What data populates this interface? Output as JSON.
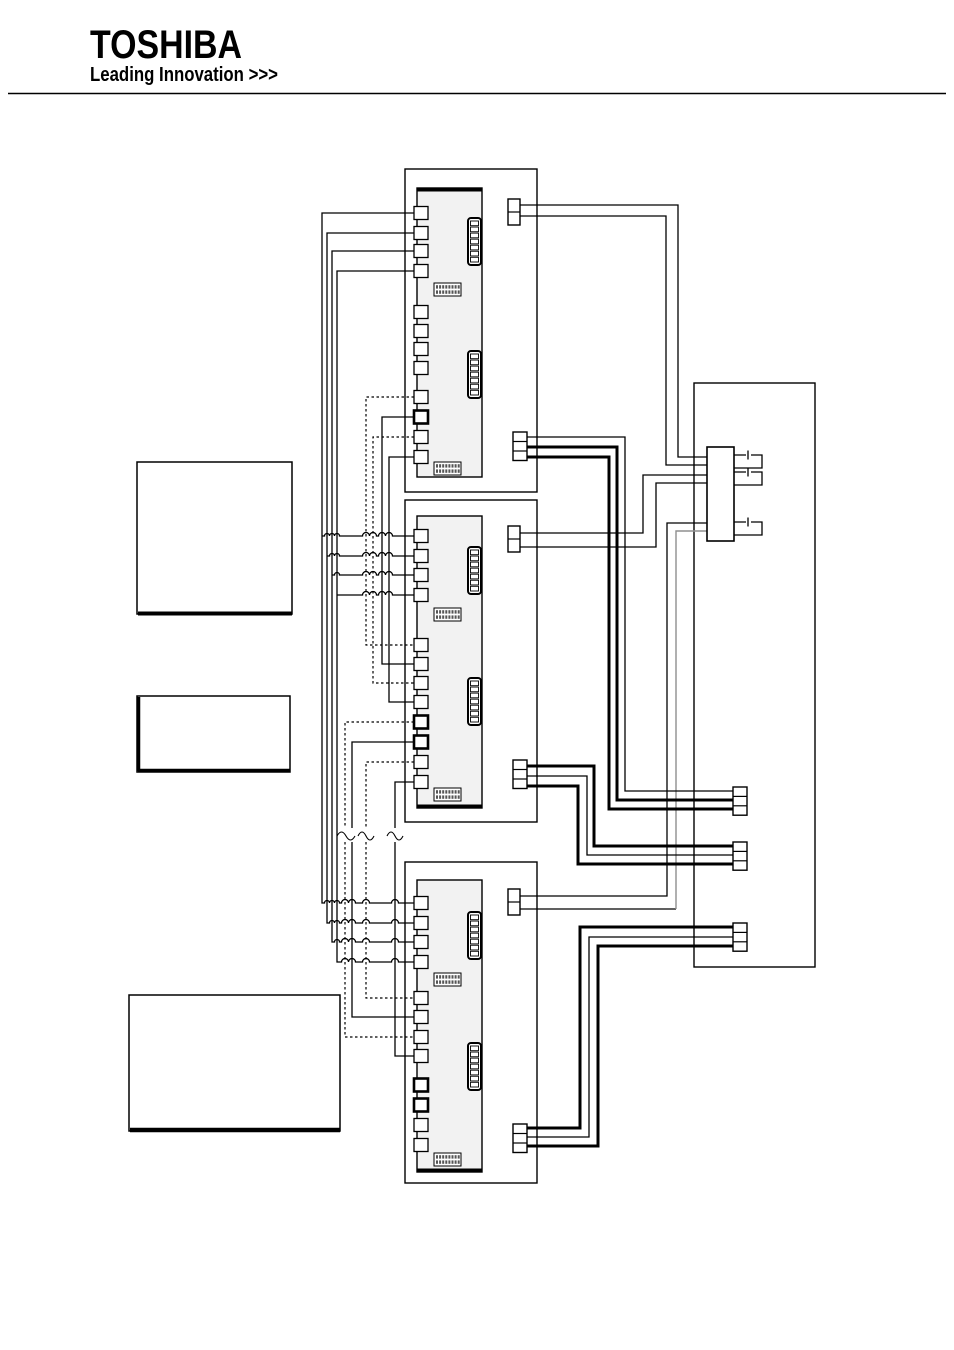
{
  "page": {
    "width": 954,
    "height": 1350,
    "bg": "#ffffff",
    "line_color": "#000000",
    "gray_wire": "#8f8f8f",
    "pcb_fill": "#f2f2f2",
    "fill_white": "#ffffff"
  },
  "logo": {
    "brand": "TOSHIBA",
    "tagline": "Leading Innovation >>>"
  },
  "diagram": {
    "description": "Wiring diagram: three indoor unit PCBs with left-side solid/dashed bus wiring (crossover hops, wavy break marks), top 2-pin and bottom 3-pin connectors, routed to right-hand box with terminal block, jumper links and three 3-pin connectors; three empty label boxes on the left",
    "shapes": [
      {
        "type": "line",
        "name": "header-rule",
        "x1": 8,
        "y1": 93.5,
        "x2": 946,
        "y2": 93.5,
        "sw": 1.5
      },
      {
        "type": "text",
        "name": "toshiba-logo-text",
        "x": 90,
        "y": 58,
        "size": 40,
        "weight": 800,
        "content_key": "brand",
        "textLength": 152
      },
      {
        "type": "text",
        "name": "toshiba-tagline-text",
        "x": 90,
        "y": 81,
        "size": 20,
        "weight": 700,
        "content_key": "tagline",
        "textLength": 188
      },
      {
        "type": "rect",
        "name": "label-box-1",
        "x": 137,
        "y": 462,
        "w": 155,
        "h": 152,
        "sw": 1.5,
        "fill": "#ffffff"
      },
      {
        "type": "path",
        "name": "label-box-1-shadow",
        "d": "M138,613.5 H292",
        "sw": 4
      },
      {
        "type": "rect",
        "name": "label-box-2",
        "x": 137,
        "y": 696,
        "w": 153,
        "h": 76,
        "sw": 1.5,
        "fill": "#ffffff"
      },
      {
        "type": "path",
        "name": "label-box-2-shadow",
        "d": "M138.5,697 V771 M138,770.5 H290",
        "sw": 3.5
      },
      {
        "type": "rect",
        "name": "label-box-3",
        "x": 129,
        "y": 995,
        "w": 211,
        "h": 136,
        "sw": 1.5,
        "fill": "#ffffff"
      },
      {
        "type": "path",
        "name": "label-box-3-shadow",
        "d": "M130,1130 H340",
        "sw": 4.5
      },
      {
        "type": "rect",
        "name": "unit-1-casing",
        "x": 405,
        "y": 169,
        "w": 132,
        "h": 323,
        "sw": 1.4,
        "fill": "none"
      },
      {
        "type": "rect",
        "name": "unit-2-casing",
        "x": 405,
        "y": 500,
        "w": 132,
        "h": 322,
        "sw": 1.4,
        "fill": "none"
      },
      {
        "type": "rect",
        "name": "unit-3-casing",
        "x": 405,
        "y": 862,
        "w": 132,
        "h": 321,
        "sw": 1.4,
        "fill": "none"
      },
      {
        "type": "rect",
        "name": "right-control-box",
        "x": 694,
        "y": 383,
        "w": 121,
        "h": 584,
        "sw": 1.4,
        "fill": "none"
      },
      {
        "type": "path",
        "name": "bus-a-wire-1",
        "d": "M414,213 H322 V903 H324.5 a2.5,2.5 0 0 1 5,0 a2.5,2.5 0 0 1 5,0 a2.5,2.5 0 0 1 5,0 H341.5 a3.5,3.5 0 0 1 7,0 a3.5,3.5 0 0 1 7,0 H362.5 a3.5,3.5 0 0 1 7,0 H391.5 a3.5,3.5 0 0 1 7,0 H414",
        "sw": 1.3
      },
      {
        "type": "path",
        "name": "bus-a-wire-2",
        "d": "M414,233 H327 V923 H329.5 a2.5,2.5 0 0 1 5,0 a2.5,2.5 0 0 1 5,0 H341.5 a3.5,3.5 0 0 1 7,0 a3.5,3.5 0 0 1 7,0 H362.5 a3.5,3.5 0 0 1 7,0 H391.5 a3.5,3.5 0 0 1 7,0 H414",
        "sw": 1.3
      },
      {
        "type": "path",
        "name": "bus-a-wire-3",
        "d": "M414,251 H332 V942 H334.5 a2.5,2.5 0 0 1 5,0 H341.5 a3.5,3.5 0 0 1 7,0 a3.5,3.5 0 0 1 7,0 H362.5 a3.5,3.5 0 0 1 7,0 H391.5 a3.5,3.5 0 0 1 7,0 H414",
        "sw": 1.3
      },
      {
        "type": "path",
        "name": "bus-a-wire-4",
        "d": "M414,271 H337 V962 H341.5 a3.5,3.5 0 0 1 7,0 a3.5,3.5 0 0 1 7,0 H362.5 a3.5,3.5 0 0 1 7,0 H391.5 a3.5,3.5 0 0 1 7,0 H414",
        "sw": 1.3
      },
      {
        "type": "path",
        "name": "bus-a-branch-unit2-1",
        "d": "M322,536 H324.5 a2.5,2.5 0 0 1 5,0 a2.5,2.5 0 0 1 5,0 a2.5,2.5 0 0 1 5,0 H362.5 a3.5,3.5 0 0 1 7,0 a3.5,3.5 0 0 1 7,0 H378.5 a3.5,3.5 0 0 1 7,0 a3.5,3.5 0 0 1 7,0 H414",
        "sw": 1.3
      },
      {
        "type": "path",
        "name": "bus-a-branch-unit2-2",
        "d": "M327,556 H329.5 a2.5,2.5 0 0 1 5,0 a2.5,2.5 0 0 1 5,0 H362.5 a3.5,3.5 0 0 1 7,0 a3.5,3.5 0 0 1 7,0 H378.5 a3.5,3.5 0 0 1 7,0 a3.5,3.5 0 0 1 7,0 H414",
        "sw": 1.3
      },
      {
        "type": "path",
        "name": "bus-a-branch-unit2-3",
        "d": "M332,575 H334.5 a2.5,2.5 0 0 1 5,0 H362.5 a3.5,3.5 0 0 1 7,0 a3.5,3.5 0 0 1 7,0 H378.5 a3.5,3.5 0 0 1 7,0 a3.5,3.5 0 0 1 7,0 H414",
        "sw": 1.3
      },
      {
        "type": "path",
        "name": "bus-a-branch-unit2-4",
        "d": "M337,595 H362.5 a3.5,3.5 0 0 1 7,0 a3.5,3.5 0 0 1 7,0 H378.5 a3.5,3.5 0 0 1 7,0 a3.5,3.5 0 0 1 7,0 H414",
        "sw": 1.3
      },
      {
        "type": "path",
        "name": "bus-b-dashed-1",
        "d": "M414,397 H366 V645 H414",
        "sw": 1.2,
        "dash": "2.5,2.5"
      },
      {
        "type": "path",
        "name": "bus-b-solid-1",
        "d": "M414,417 H382 V664 H414",
        "sw": 1.3
      },
      {
        "type": "path",
        "name": "bus-b-dashed-2",
        "d": "M414,437 H373 V683 H414",
        "sw": 1.2,
        "dash": "2.5,2.5"
      },
      {
        "type": "path",
        "name": "bus-b-solid-2",
        "d": "M414,457 H389 V702 H414",
        "sw": 1.3
      },
      {
        "type": "path",
        "name": "bus-c-dashed-1",
        "d": "M414,722 H345 V828 M345,842 V1037 H414",
        "sw": 1.2,
        "dash": "2.5,2.5"
      },
      {
        "type": "path",
        "name": "bus-c-solid-1",
        "d": "M414,742 H352 V828 M352,842 V1017 H414",
        "sw": 1.3
      },
      {
        "type": "path",
        "name": "bus-c-dashed-2",
        "d": "M414,762 H366 V828 M366,842 V998 H414",
        "sw": 1.2,
        "dash": "2.5,2.5"
      },
      {
        "type": "path",
        "name": "bus-c-solid-2",
        "d": "M414,782 H395 V828 M395,842 V1056 H414",
        "sw": 1.3
      },
      {
        "type": "path",
        "name": "wire-break-squiggle-1",
        "d": "M337,836 q4.5,-8 9,0 q4.5,8 9,0",
        "sw": 1.1
      },
      {
        "type": "path",
        "name": "wire-break-squiggle-2",
        "d": "M358,836 q4,-8 8,0 q4,8 8,0",
        "sw": 1.1
      },
      {
        "type": "path",
        "name": "wire-break-squiggle-3",
        "d": "M387,836 q4,-8 8,0 q4,8 8,0",
        "sw": 1.1
      },
      {
        "type": "path",
        "name": "unit1-topconn-wire-1",
        "d": "M520,205 H678 V457 H707",
        "sw": 1.3
      },
      {
        "type": "path",
        "name": "unit1-topconn-wire-2",
        "d": "M520,216 H666 V465 H707",
        "sw": 1.3
      },
      {
        "type": "path",
        "name": "unit2-topconn-wire-1",
        "d": "M520,533 H643 V475 H707",
        "sw": 1.3
      },
      {
        "type": "path",
        "name": "unit2-topconn-wire-2",
        "d": "M520,547 H656 V483 H707",
        "sw": 1.3
      },
      {
        "type": "path",
        "name": "unit3-topconn-wire-1",
        "d": "M520,896 H667 V523 H707",
        "sw": 1.3
      },
      {
        "type": "path",
        "name": "unit3-topconn-wire-2a",
        "d": "M520,909 H676",
        "sw": 1.3
      },
      {
        "type": "path",
        "name": "unit3-topconn-wire-2b-gray",
        "d": "M676,909 V531 H707",
        "sw": 1.4,
        "color": "#8f8f8f"
      },
      {
        "type": "path",
        "name": "unit1-botconn-wire-thin",
        "d": "M527,437 H625 V791 H733",
        "sw": 1.3
      },
      {
        "type": "path",
        "name": "unit1-botconn-wire-thick-1",
        "d": "M527,447 H617 V800 H733",
        "sw": 3
      },
      {
        "type": "path",
        "name": "unit1-botconn-wire-thick-2",
        "d": "M527,457 H609 V809 H733",
        "sw": 3
      },
      {
        "type": "path",
        "name": "unit2-botconn-wire-thick-1",
        "d": "M527,766 H594 V846 H733",
        "sw": 3
      },
      {
        "type": "path",
        "name": "unit2-botconn-wire-thin",
        "d": "M527,776 H587 V855 H733",
        "sw": 1.3
      },
      {
        "type": "path",
        "name": "unit2-botconn-wire-thick-2",
        "d": "M527,786 H578 V864 H733",
        "sw": 3
      },
      {
        "type": "path",
        "name": "unit3-botconn-wire-thick-1",
        "d": "M527,1128 H580 V927 H733",
        "sw": 3
      },
      {
        "type": "path",
        "name": "unit3-botconn-wire-thin",
        "d": "M527,1137 H589 V937 H733",
        "sw": 1.3
      },
      {
        "type": "path",
        "name": "unit3-botconn-wire-thick-2",
        "d": "M527,1146 H598 V946 H733",
        "sw": 3
      },
      {
        "type": "rect",
        "name": "unit-1-pcb",
        "x": 417,
        "y": 188,
        "w": 65,
        "h": 289,
        "sw": 1.4,
        "fill": "#f2f2f2"
      },
      {
        "type": "path",
        "name": "unit-1-pcb-edge",
        "d": "M417,189.8 H482",
        "sw": 3.5
      },
      {
        "type": "rect",
        "name": "unit-2-pcb",
        "x": 417,
        "y": 516,
        "w": 65,
        "h": 292,
        "sw": 1.4,
        "fill": "#f2f2f2"
      },
      {
        "type": "path",
        "name": "unit-2-pcb-edge",
        "d": "M417,806.2 H482",
        "sw": 3.5
      },
      {
        "type": "rect",
        "name": "unit-3-pcb",
        "x": 417,
        "y": 880,
        "w": 65,
        "h": 292,
        "sw": 1.4,
        "fill": "#f2f2f2"
      },
      {
        "type": "path",
        "name": "unit-3-pcb-edge",
        "d": "M417,1170.2 H482",
        "sw": 3.5
      },
      {
        "type": "squares",
        "name": "unit-1-terminals",
        "x": 414,
        "ys": [
          213,
          233,
          251,
          271,
          312,
          331,
          349,
          368,
          397,
          417,
          437,
          457
        ],
        "bold": [
          417
        ]
      },
      {
        "type": "squares",
        "name": "unit-2-terminals",
        "x": 414,
        "ys": [
          536,
          556,
          575,
          595,
          645,
          664,
          683,
          702,
          722,
          742,
          762,
          782
        ],
        "bold": [
          722,
          742
        ]
      },
      {
        "type": "squares",
        "name": "unit-3-terminals",
        "x": 414,
        "ys": [
          903,
          923,
          942,
          962,
          998,
          1017,
          1037,
          1056,
          1085,
          1105,
          1125,
          1145
        ],
        "bold": [
          1085,
          1105
        ]
      },
      {
        "type": "header",
        "name": "unit-1-pin-header-1",
        "x": 468,
        "y": 218,
        "w": 13,
        "h": 47,
        "pins": 7
      },
      {
        "type": "header",
        "name": "unit-1-pin-header-2",
        "x": 468,
        "y": 351,
        "w": 13,
        "h": 47,
        "pins": 7
      },
      {
        "type": "header",
        "name": "unit-2-pin-header-1",
        "x": 468,
        "y": 547,
        "w": 13,
        "h": 47,
        "pins": 7
      },
      {
        "type": "header",
        "name": "unit-2-pin-header-2",
        "x": 468,
        "y": 678,
        "w": 13,
        "h": 47,
        "pins": 7
      },
      {
        "type": "header",
        "name": "unit-3-pin-header-1",
        "x": 468,
        "y": 912,
        "w": 13,
        "h": 47,
        "pins": 7
      },
      {
        "type": "header",
        "name": "unit-3-pin-header-2",
        "x": 468,
        "y": 1043,
        "w": 13,
        "h": 47,
        "pins": 7
      },
      {
        "type": "dip",
        "name": "unit-1-dip-switch-1",
        "x": 434,
        "y": 283,
        "w": 27,
        "h": 13
      },
      {
        "type": "dip",
        "name": "unit-1-dip-switch-2",
        "x": 434,
        "y": 462,
        "w": 27,
        "h": 13
      },
      {
        "type": "dip",
        "name": "unit-2-dip-switch-1",
        "x": 434,
        "y": 608,
        "w": 27,
        "h": 13
      },
      {
        "type": "dip",
        "name": "unit-2-dip-switch-2",
        "x": 434,
        "y": 788,
        "w": 27,
        "h": 13
      },
      {
        "type": "dip",
        "name": "unit-3-dip-switch-1",
        "x": 434,
        "y": 973,
        "w": 27,
        "h": 13
      },
      {
        "type": "dip",
        "name": "unit-3-dip-switch-2",
        "x": 434,
        "y": 1153,
        "w": 27,
        "h": 13
      },
      {
        "type": "cells",
        "name": "unit-1-top-connector",
        "x": 508,
        "y": 199,
        "w": 12,
        "cellH": 13,
        "n": 2
      },
      {
        "type": "cells",
        "name": "unit-2-top-connector",
        "x": 508,
        "y": 526,
        "w": 12,
        "cellH": 13,
        "n": 2
      },
      {
        "type": "cells",
        "name": "unit-3-top-connector",
        "x": 508,
        "y": 889,
        "w": 12,
        "cellH": 13,
        "n": 2
      },
      {
        "type": "cells",
        "name": "unit-1-bottom-connector",
        "x": 513,
        "y": 432,
        "w": 14,
        "cellH": 9.5,
        "n": 3
      },
      {
        "type": "cells",
        "name": "unit-2-bottom-connector",
        "x": 513,
        "y": 760,
        "w": 14,
        "cellH": 9.5,
        "n": 3
      },
      {
        "type": "cells",
        "name": "unit-3-bottom-connector",
        "x": 513,
        "y": 1124,
        "w": 14,
        "cellH": 9.5,
        "n": 3
      },
      {
        "type": "rect",
        "name": "terminal-block",
        "x": 707,
        "y": 447,
        "w": 27,
        "h": 94,
        "sw": 1.6,
        "fill": "#ffffff"
      },
      {
        "type": "path",
        "name": "terminal-jumper-1",
        "d": "M734,455 H746 M748,450.5 V459.5 M751,455 H762 V468 H734",
        "sw": 1.3
      },
      {
        "type": "path",
        "name": "terminal-jumper-2",
        "d": "M734,472 H746 M748,467.5 V476.5 M751,472 H762 V485 H734",
        "sw": 1.3
      },
      {
        "type": "path",
        "name": "terminal-jumper-3",
        "d": "M734,522 H746 M748,517.5 V526.5 M751,522 H762 V535 H734",
        "sw": 1.3
      },
      {
        "type": "cells",
        "name": "right-box-connector-a",
        "x": 733,
        "y": 787,
        "w": 14,
        "cellH": 9.4,
        "n": 3
      },
      {
        "type": "cells",
        "name": "right-box-connector-b",
        "x": 733,
        "y": 842,
        "w": 14,
        "cellH": 9.4,
        "n": 3
      },
      {
        "type": "cells",
        "name": "right-box-connector-c",
        "x": 733,
        "y": 923,
        "w": 14,
        "cellH": 9.4,
        "n": 3
      }
    ]
  }
}
